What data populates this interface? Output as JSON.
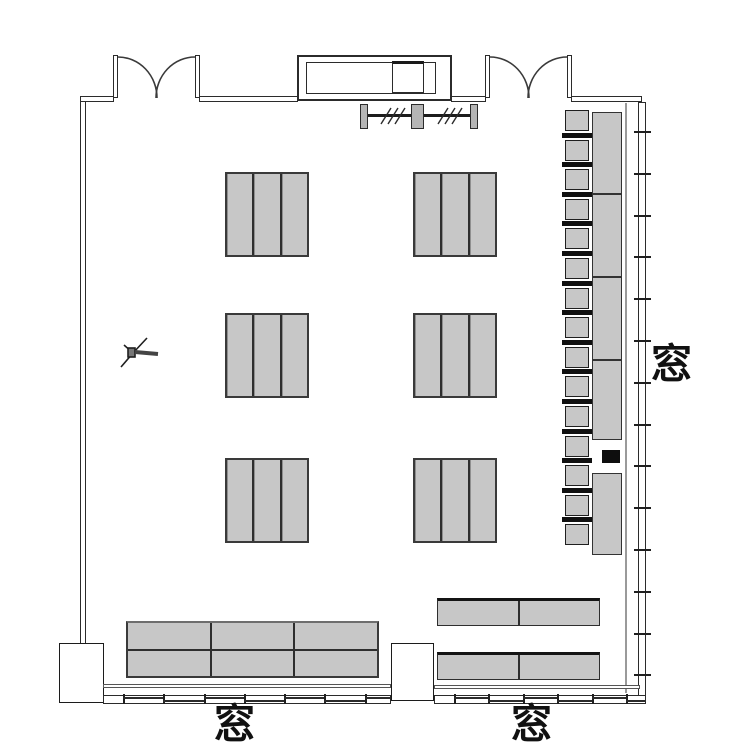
{
  "plan": {
    "kind": "room floor plan",
    "labels": {
      "right_window": "窓",
      "bottom_left_window": "窓",
      "bottom_right_window": "窓"
    },
    "colors": {
      "background": "#ffffff",
      "wall_line": "#2b2b2b",
      "furniture_fill": "#c7c7c7",
      "furniture_border": "#3a3a3a",
      "chair_back": "#101010",
      "equipment_box": "#0e0e0e"
    },
    "furniture": {
      "center_desk_groups": {
        "rows": 3,
        "cols": 2,
        "desks_per_group": 3
      },
      "side_chairs": {
        "count": 15
      },
      "window_counter": {
        "upper_segments": 4,
        "lower_segments": 1
      },
      "back_table": {
        "cols": 3,
        "rows": 2
      },
      "bottom_right_tables": {
        "count": 2,
        "segments_each": 2
      },
      "doors": {
        "count": 2,
        "type": "double-swing"
      },
      "partition_posts": 3
    },
    "windows": {
      "right_tick_count": 14,
      "bottom_left_tick_count": 7,
      "bottom_right_tick_count": 6
    }
  }
}
